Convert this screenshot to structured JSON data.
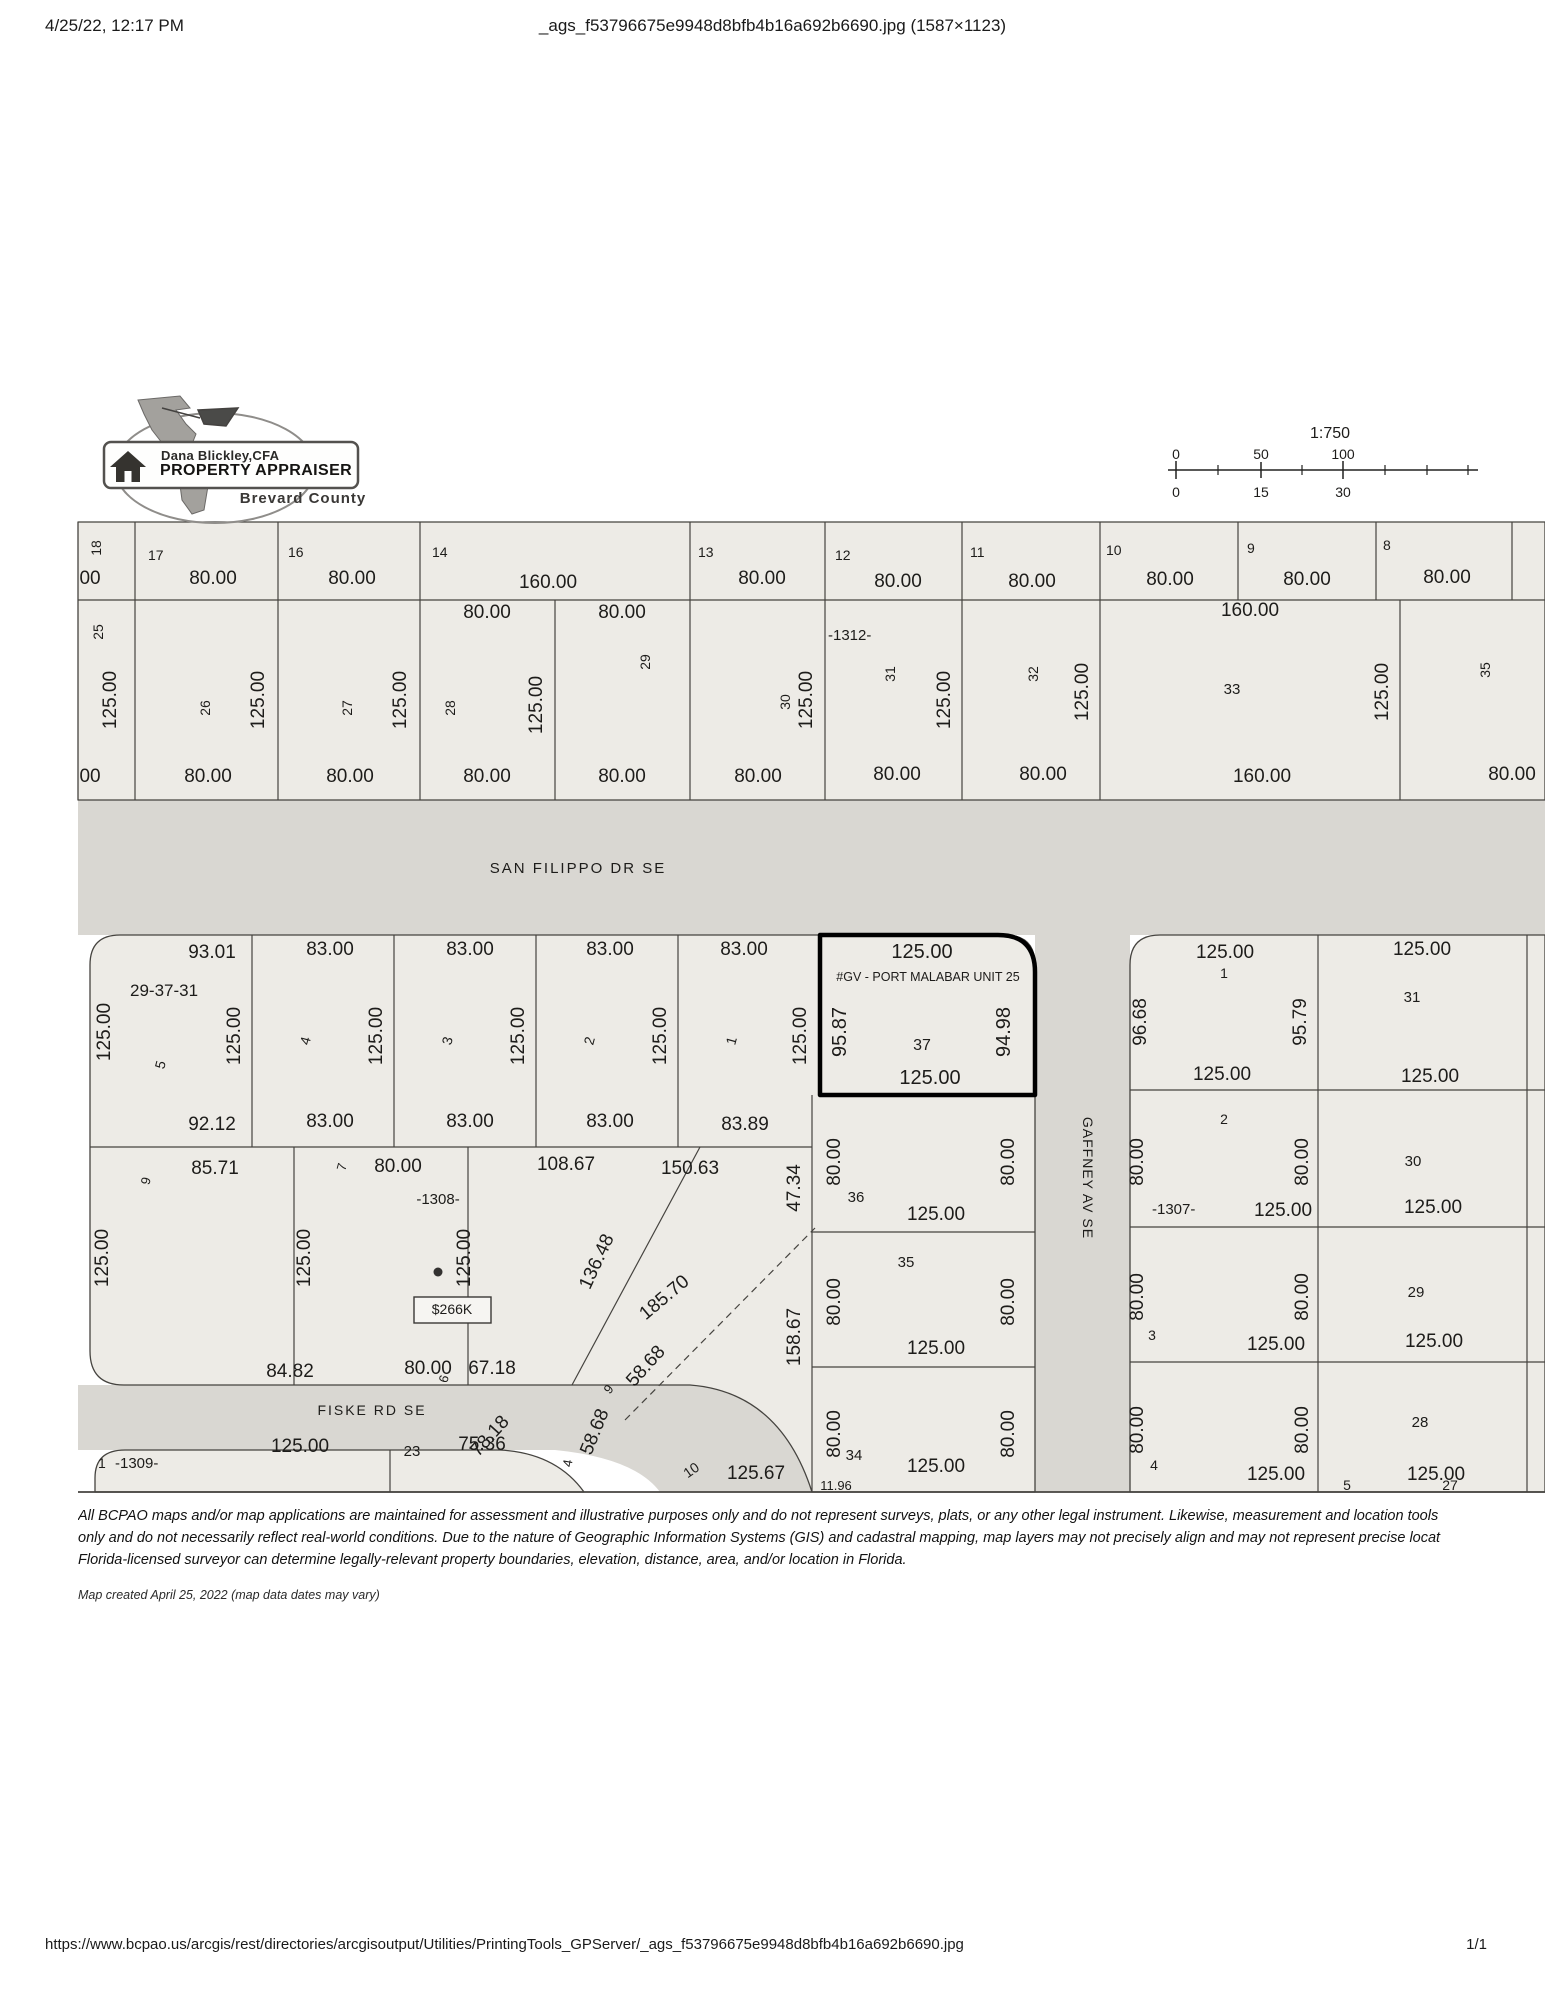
{
  "page": {
    "header": {
      "date": "4/25/22, 12:17 PM",
      "title": "_ags_f53796675e9948d8bfb4b16a692b6690.jpg (1587×1123)"
    },
    "footer": {
      "url": "https://www.bcpao.us/arcgis/rest/directories/arcgisoutput/Utilities/PrintingTools_GPServer/_ags_f53796675e9948d8bfb4b16a692b6690.jpg",
      "page_indicator": "1/1"
    }
  },
  "logo": {
    "line1": "Dana Blickley,CFA",
    "line2": "PROPERTY APPRAISER",
    "line3": "Brevard County"
  },
  "disclaimer": {
    "line1": "All BCPAO maps and/or map applications are maintained for assessment and illustrative purposes only and do not represent surveys, plats, or any other legal instrument. Likewise, measurement and location tools",
    "line2": "only and do not necessarily reflect real-world conditions. Due to the nature of Geographic Information Systems (GIS) and cadastral mapping, map layers may not precisely align and may not represent precise locat",
    "line3": "Florida-licensed surveyor can determine legally-relevant property boundaries, elevation, distance, area, and/or location in Florida.",
    "created": "Map created April 25, 2022 (map data dates may vary)"
  },
  "map": {
    "colors": {
      "lot_fill": "#edebe6",
      "road_fill": "#d9d7d2",
      "line": "#44423e",
      "selected_outline": "#000000"
    },
    "labels": [
      {
        "t": "1:750",
        "x": 1330,
        "y": 438,
        "s": 16,
        "n": "scale-ratio"
      },
      {
        "t": "0",
        "x": 1176,
        "y": 459,
        "s": 14,
        "n": "scale-top-0"
      },
      {
        "t": "50",
        "x": 1261,
        "y": 459,
        "s": 14,
        "n": "scale-top-50"
      },
      {
        "t": "100",
        "x": 1343,
        "y": 459,
        "s": 14,
        "n": "scale-top-100"
      },
      {
        "t": "0",
        "x": 1176,
        "y": 497,
        "s": 14,
        "n": "scale-bottom-0"
      },
      {
        "t": "15",
        "x": 1261,
        "y": 497,
        "s": 14,
        "n": "scale-bottom-15"
      },
      {
        "t": "30",
        "x": 1343,
        "y": 497,
        "s": 14,
        "n": "scale-bottom-30"
      },
      {
        "t": "18",
        "x": 101,
        "y": 548,
        "r": -90,
        "s": 14
      },
      {
        "t": "00",
        "x": 90,
        "y": 584
      },
      {
        "t": "17",
        "x": 148,
        "y": 560,
        "s": 14,
        "a": "start"
      },
      {
        "t": "80.00",
        "x": 213,
        "y": 584
      },
      {
        "t": "16",
        "x": 288,
        "y": 557,
        "s": 14,
        "a": "start"
      },
      {
        "t": "80.00",
        "x": 352,
        "y": 584
      },
      {
        "t": "14",
        "x": 432,
        "y": 557,
        "s": 14,
        "a": "start"
      },
      {
        "t": "160.00",
        "x": 548,
        "y": 588
      },
      {
        "t": "13",
        "x": 698,
        "y": 557,
        "s": 14,
        "a": "start"
      },
      {
        "t": "80.00",
        "x": 762,
        "y": 584
      },
      {
        "t": "12",
        "x": 835,
        "y": 560,
        "s": 14,
        "a": "start"
      },
      {
        "t": "80.00",
        "x": 898,
        "y": 587
      },
      {
        "t": "11",
        "x": 970,
        "y": 557,
        "s": 14,
        "a": "start"
      },
      {
        "t": "80.00",
        "x": 1032,
        "y": 587
      },
      {
        "t": "10",
        "x": 1106,
        "y": 555,
        "s": 14,
        "a": "start"
      },
      {
        "t": "80.00",
        "x": 1170,
        "y": 585
      },
      {
        "t": "9",
        "x": 1247,
        "y": 553,
        "s": 14,
        "a": "start"
      },
      {
        "t": "80.00",
        "x": 1307,
        "y": 585
      },
      {
        "t": "8",
        "x": 1383,
        "y": 550,
        "s": 14,
        "a": "start"
      },
      {
        "t": "80.00",
        "x": 1447,
        "y": 583
      },
      {
        "t": "25",
        "x": 103,
        "y": 632,
        "r": -90,
        "s": 14
      },
      {
        "t": "125.00",
        "x": 116,
        "y": 700,
        "r": -90
      },
      {
        "t": "26",
        "x": 210,
        "y": 708,
        "r": -90,
        "s": 14
      },
      {
        "t": "125.00",
        "x": 264,
        "y": 700,
        "r": -90
      },
      {
        "t": "27",
        "x": 352,
        "y": 708,
        "r": -90,
        "s": 14
      },
      {
        "t": "125.00",
        "x": 406,
        "y": 700,
        "r": -90
      },
      {
        "t": "80.00",
        "x": 487,
        "y": 618
      },
      {
        "t": "80.00",
        "x": 622,
        "y": 618
      },
      {
        "t": "29",
        "x": 650,
        "y": 662,
        "r": -90,
        "s": 14
      },
      {
        "t": "28",
        "x": 455,
        "y": 708,
        "r": -90,
        "s": 14
      },
      {
        "t": "125.00",
        "x": 542,
        "y": 705,
        "r": -90
      },
      {
        "t": "30",
        "x": 790,
        "y": 702,
        "r": -90,
        "s": 14
      },
      {
        "t": "125.00",
        "x": 812,
        "y": 700,
        "r": -90
      },
      {
        "t": "-1312-",
        "x": 828,
        "y": 640,
        "s": 15,
        "a": "start",
        "n": "block-label-1312"
      },
      {
        "t": "31",
        "x": 895,
        "y": 674,
        "r": -90,
        "s": 14
      },
      {
        "t": "125.00",
        "x": 950,
        "y": 700,
        "r": -90
      },
      {
        "t": "32",
        "x": 1038,
        "y": 674,
        "r": -90,
        "s": 14
      },
      {
        "t": "125.00",
        "x": 1088,
        "y": 692,
        "r": -90
      },
      {
        "t": "160.00",
        "x": 1250,
        "y": 616
      },
      {
        "t": "33",
        "x": 1232,
        "y": 694,
        "s": 15
      },
      {
        "t": "125.00",
        "x": 1388,
        "y": 692,
        "r": -90
      },
      {
        "t": "35",
        "x": 1490,
        "y": 670,
        "r": -90,
        "s": 14
      },
      {
        "t": "00",
        "x": 90,
        "y": 782
      },
      {
        "t": "80.00",
        "x": 208,
        "y": 782
      },
      {
        "t": "80.00",
        "x": 350,
        "y": 782
      },
      {
        "t": "80.00",
        "x": 487,
        "y": 782
      },
      {
        "t": "80.00",
        "x": 622,
        "y": 782
      },
      {
        "t": "80.00",
        "x": 758,
        "y": 782
      },
      {
        "t": "80.00",
        "x": 897,
        "y": 780
      },
      {
        "t": "80.00",
        "x": 1043,
        "y": 780
      },
      {
        "t": "160.00",
        "x": 1262,
        "y": 782
      },
      {
        "t": "80.00",
        "x": 1512,
        "y": 780
      },
      {
        "t": "SAN FILIPPO DR SE",
        "x": 578,
        "y": 873,
        "s": 15,
        "ls": 2,
        "n": "road-label-san-filippo"
      },
      {
        "t": "93.01",
        "x": 212,
        "y": 958
      },
      {
        "t": "83.00",
        "x": 330,
        "y": 955
      },
      {
        "t": "83.00",
        "x": 470,
        "y": 955
      },
      {
        "t": "83.00",
        "x": 610,
        "y": 955
      },
      {
        "t": "83.00",
        "x": 744,
        "y": 955
      },
      {
        "t": "29-37-31",
        "x": 130,
        "y": 996,
        "s": 17,
        "a": "start",
        "n": "section-township-range-label"
      },
      {
        "t": "125.00",
        "x": 110,
        "y": 1032,
        "r": -90
      },
      {
        "t": "5",
        "x": 165,
        "y": 1066,
        "r": -75,
        "s": 14
      },
      {
        "t": "125.00",
        "x": 240,
        "y": 1036,
        "r": -90
      },
      {
        "t": "4",
        "x": 310,
        "y": 1042,
        "r": -75,
        "s": 14
      },
      {
        "t": "125.00",
        "x": 382,
        "y": 1036,
        "r": -90
      },
      {
        "t": "3",
        "x": 452,
        "y": 1042,
        "r": -75,
        "s": 14
      },
      {
        "t": "125.00",
        "x": 524,
        "y": 1036,
        "r": -90
      },
      {
        "t": "2",
        "x": 594,
        "y": 1042,
        "r": -75,
        "s": 14
      },
      {
        "t": "125.00",
        "x": 666,
        "y": 1036,
        "r": -90
      },
      {
        "t": "1",
        "x": 736,
        "y": 1042,
        "r": -75,
        "s": 14
      },
      {
        "t": "125.00",
        "x": 806,
        "y": 1036,
        "r": -90
      },
      {
        "t": "92.12",
        "x": 212,
        "y": 1130
      },
      {
        "t": "83.00",
        "x": 330,
        "y": 1127
      },
      {
        "t": "83.00",
        "x": 470,
        "y": 1127
      },
      {
        "t": "83.00",
        "x": 610,
        "y": 1127
      },
      {
        "t": "83.89",
        "x": 745,
        "y": 1130
      },
      {
        "t": "125.00",
        "x": 922,
        "y": 958,
        "s": 20,
        "n": "selected-parcel-front-dim"
      },
      {
        "t": "#GV - PORT MALABAR UNIT 25",
        "x": 928,
        "y": 981,
        "s": 12.5,
        "n": "subdivision-label"
      },
      {
        "t": "95.87",
        "x": 846,
        "y": 1032,
        "r": -90,
        "s": 20
      },
      {
        "t": "94.98",
        "x": 1010,
        "y": 1032,
        "r": -90,
        "s": 20
      },
      {
        "t": "37",
        "x": 922,
        "y": 1050,
        "s": 16,
        "n": "selected-parcel-number"
      },
      {
        "t": "125.00",
        "x": 930,
        "y": 1084,
        "s": 20,
        "n": "selected-parcel-rear-dim"
      },
      {
        "t": "GAFFNEY AV SE",
        "x": 1083,
        "y": 1178,
        "r": 90,
        "s": 14,
        "ls": 1,
        "n": "road-label-gaffney"
      },
      {
        "t": "125.00",
        "x": 1225,
        "y": 958
      },
      {
        "t": "1",
        "x": 1224,
        "y": 978,
        "s": 14
      },
      {
        "t": "96.68",
        "x": 1146,
        "y": 1022,
        "r": -90
      },
      {
        "t": "95.79",
        "x": 1306,
        "y": 1022,
        "r": -90
      },
      {
        "t": "31",
        "x": 1412,
        "y": 1002,
        "s": 15
      },
      {
        "t": "125.00",
        "x": 1422,
        "y": 955
      },
      {
        "t": "125.00",
        "x": 1222,
        "y": 1080
      },
      {
        "t": "125.00",
        "x": 1430,
        "y": 1082
      },
      {
        "t": "2",
        "x": 1224,
        "y": 1124,
        "s": 14
      },
      {
        "t": "80.00",
        "x": 1143,
        "y": 1162,
        "r": -90
      },
      {
        "t": "80.00",
        "x": 1308,
        "y": 1162,
        "r": -90
      },
      {
        "t": "30",
        "x": 1413,
        "y": 1166,
        "s": 15
      },
      {
        "t": "-1307-",
        "x": 1152,
        "y": 1214,
        "s": 15,
        "a": "start",
        "n": "block-label-1307"
      },
      {
        "t": "125.00",
        "x": 1283,
        "y": 1216
      },
      {
        "t": "125.00",
        "x": 1433,
        "y": 1213
      },
      {
        "t": "80.00",
        "x": 1143,
        "y": 1297,
        "r": -90
      },
      {
        "t": "80.00",
        "x": 1308,
        "y": 1297,
        "r": -90
      },
      {
        "t": "3",
        "x": 1152,
        "y": 1340,
        "s": 14
      },
      {
        "t": "29",
        "x": 1416,
        "y": 1297,
        "s": 15
      },
      {
        "t": "125.00",
        "x": 1276,
        "y": 1350
      },
      {
        "t": "125.00",
        "x": 1434,
        "y": 1347
      },
      {
        "t": "80.00",
        "x": 1143,
        "y": 1430,
        "r": -90
      },
      {
        "t": "80.00",
        "x": 1308,
        "y": 1430,
        "r": -90
      },
      {
        "t": "28",
        "x": 1420,
        "y": 1427,
        "s": 15
      },
      {
        "t": "4",
        "x": 1154,
        "y": 1470,
        "s": 14
      },
      {
        "t": "125.00",
        "x": 1276,
        "y": 1480
      },
      {
        "t": "5",
        "x": 1347,
        "y": 1490,
        "s": 14
      },
      {
        "t": "125.00",
        "x": 1436,
        "y": 1480
      },
      {
        "t": "27",
        "x": 1450,
        "y": 1490,
        "s": 14
      },
      {
        "t": "80.00",
        "x": 840,
        "y": 1162,
        "r": -90
      },
      {
        "t": "80.00",
        "x": 1014,
        "y": 1162,
        "r": -90
      },
      {
        "t": "36",
        "x": 856,
        "y": 1202,
        "s": 15
      },
      {
        "t": "125.00",
        "x": 936,
        "y": 1220
      },
      {
        "t": "35",
        "x": 906,
        "y": 1267,
        "s": 15
      },
      {
        "t": "80.00",
        "x": 840,
        "y": 1302,
        "r": -90
      },
      {
        "t": "80.00",
        "x": 1014,
        "y": 1302,
        "r": -90
      },
      {
        "t": "125.00",
        "x": 936,
        "y": 1354
      },
      {
        "t": "80.00",
        "x": 840,
        "y": 1434,
        "r": -90
      },
      {
        "t": "80.00",
        "x": 1014,
        "y": 1434,
        "r": -90
      },
      {
        "t": "34",
        "x": 854,
        "y": 1460,
        "s": 15
      },
      {
        "t": "125.00",
        "x": 936,
        "y": 1472
      },
      {
        "t": "47.34",
        "x": 800,
        "y": 1188,
        "r": -90
      },
      {
        "t": "158.67",
        "x": 800,
        "y": 1337,
        "r": -90
      },
      {
        "t": "150.63",
        "x": 690,
        "y": 1174
      },
      {
        "t": "185.70",
        "x": 668,
        "y": 1302,
        "r": -40
      },
      {
        "t": "136.48",
        "x": 602,
        "y": 1264,
        "r": -65
      },
      {
        "t": "9",
        "x": 150,
        "y": 1182,
        "r": -75,
        "s": 13
      },
      {
        "t": "85.71",
        "x": 215,
        "y": 1174
      },
      {
        "t": "7",
        "x": 346,
        "y": 1168,
        "r": -75,
        "s": 13
      },
      {
        "t": "80.00",
        "x": 398,
        "y": 1172
      },
      {
        "t": "-1308-",
        "x": 438,
        "y": 1204,
        "s": 15,
        "n": "block-label-1308"
      },
      {
        "t": "108.67",
        "x": 566,
        "y": 1170
      },
      {
        "t": "125.00",
        "x": 108,
        "y": 1258,
        "r": -90
      },
      {
        "t": "125.00",
        "x": 310,
        "y": 1258,
        "r": -90
      },
      {
        "t": "125.00",
        "x": 470,
        "y": 1258,
        "r": -90
      },
      {
        "t": "84.82",
        "x": 290,
        "y": 1377
      },
      {
        "t": "80.00",
        "x": 428,
        "y": 1374
      },
      {
        "t": "6",
        "x": 448,
        "y": 1380,
        "r": -75,
        "s": 13
      },
      {
        "t": "67.18",
        "x": 492,
        "y": 1374
      },
      {
        "t": "$266K",
        "x": 452,
        "y": 1314,
        "s": 14,
        "n": "sale-price-callout-text"
      },
      {
        "t": "9",
        "x": 612,
        "y": 1392,
        "r": -50,
        "s": 13
      },
      {
        "t": "58.68",
        "x": 650,
        "y": 1370,
        "r": -48
      },
      {
        "t": "58.68",
        "x": 600,
        "y": 1434,
        "r": -68
      },
      {
        "t": "78.18",
        "x": 494,
        "y": 1440,
        "r": -48
      },
      {
        "t": "10",
        "x": 694,
        "y": 1474,
        "r": -35,
        "s": 14
      },
      {
        "t": "125.67",
        "x": 756,
        "y": 1479
      },
      {
        "t": "11.96",
        "x": 836,
        "y": 1490,
        "s": 13
      },
      {
        "t": "FISKE RD SE",
        "x": 372,
        "y": 1415,
        "s": 14,
        "ls": 2,
        "n": "road-label-fiske"
      },
      {
        "t": "1",
        "x": 98,
        "y": 1468,
        "s": 14,
        "a": "start"
      },
      {
        "t": "-1309-",
        "x": 115,
        "y": 1468,
        "s": 15,
        "a": "start",
        "n": "block-label-1309"
      },
      {
        "t": "125.00",
        "x": 300,
        "y": 1452
      },
      {
        "t": "23",
        "x": 412,
        "y": 1456,
        "s": 15
      },
      {
        "t": "75.36",
        "x": 482,
        "y": 1450
      },
      {
        "t": "4",
        "x": 572,
        "y": 1464,
        "r": -80,
        "s": 13
      }
    ]
  }
}
